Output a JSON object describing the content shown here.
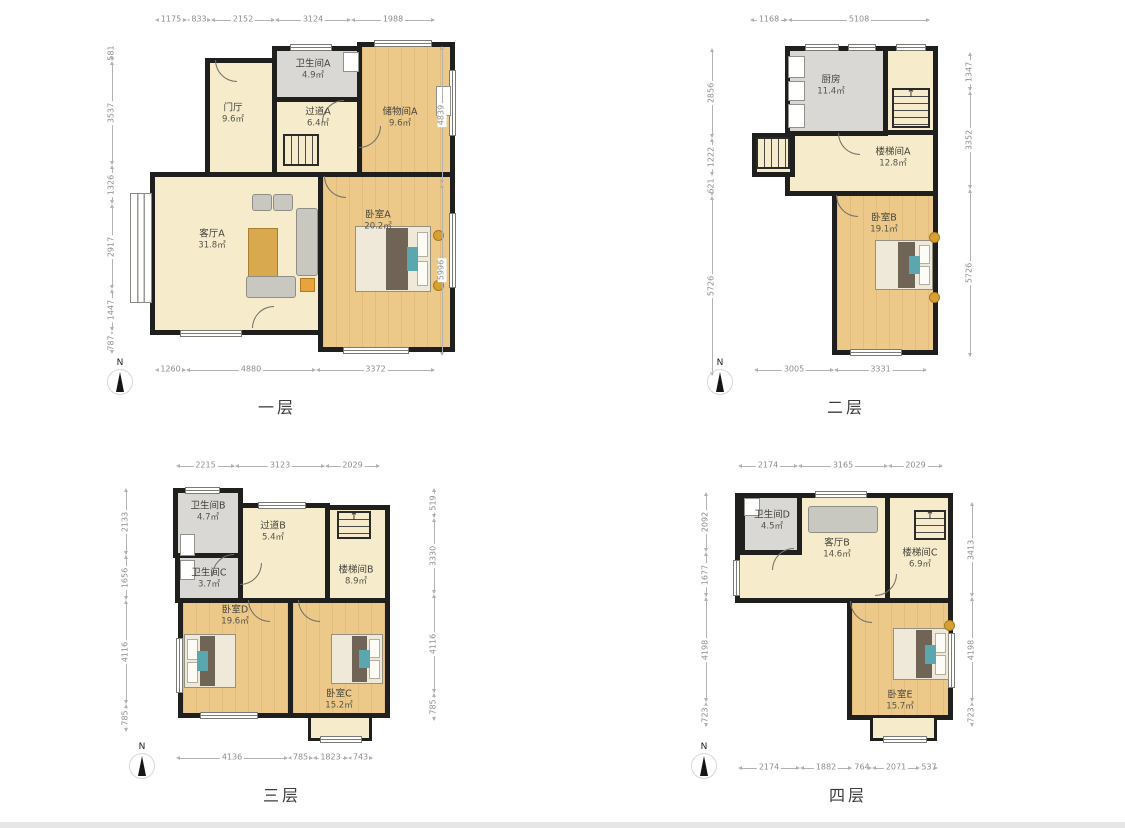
{
  "colors": {
    "wall": "#1f1f1e",
    "wood_floor": "#ecc988",
    "living_floor": "#f6eccb",
    "wet_room": "#d9d8d4",
    "dim_text": "#8e8d89"
  },
  "icons": {
    "up_arrow": "↑"
  },
  "floors": [
    {
      "label": "一层",
      "north": "N",
      "rooms": [
        {
          "name": "门厅",
          "area": "9.6㎡"
        },
        {
          "name": "卫生间A",
          "area": "4.9㎡"
        },
        {
          "name": "过道A",
          "area": "6.4㎡"
        },
        {
          "name": "储物间A",
          "area": "9.6㎡"
        },
        {
          "name": "客厅A",
          "area": "31.8㎡"
        },
        {
          "name": "卧室A",
          "area": "20.2㎡"
        }
      ],
      "dims": {
        "top": [
          "1175",
          "833",
          "2152",
          "3124",
          "1988"
        ],
        "left": [
          "581",
          "3537",
          "1326",
          "2917",
          "1447",
          "787"
        ],
        "right": [
          "4839",
          "5996"
        ],
        "bottom": [
          "1260",
          "4880",
          "3372"
        ]
      }
    },
    {
      "label": "二层",
      "north": "N",
      "rooms": [
        {
          "name": "厨房",
          "area": "11.4㎡"
        },
        {
          "name": "楼梯间A",
          "area": "12.8㎡"
        },
        {
          "name": "卧室B",
          "area": "19.1㎡"
        }
      ],
      "dims": {
        "top": [
          "1168",
          "5108"
        ],
        "left": [
          "2856",
          "1222",
          "621",
          "5726"
        ],
        "right": [
          "1347",
          "3352",
          "5726"
        ],
        "bottom": [
          "3005",
          "3331"
        ]
      }
    },
    {
      "label": "三层",
      "north": "N",
      "rooms": [
        {
          "name": "卫生间B",
          "area": "4.7㎡"
        },
        {
          "name": "过道B",
          "area": "5.4㎡"
        },
        {
          "name": "楼梯间B",
          "area": "8.9㎡"
        },
        {
          "name": "卫生间C",
          "area": "3.7㎡"
        },
        {
          "name": "卧室D",
          "area": "19.6㎡"
        },
        {
          "name": "卧室C",
          "area": "15.2㎡"
        }
      ],
      "dims": {
        "top": [
          "2215",
          "3123",
          "2029"
        ],
        "left": [
          "2133",
          "1656",
          "4116",
          "785"
        ],
        "right": [
          "519",
          "3330",
          "4116",
          "785"
        ],
        "bottom": [
          "4136",
          "785",
          "1823",
          "743"
        ]
      }
    },
    {
      "label": "四层",
      "north": "N",
      "rooms": [
        {
          "name": "卫生间D",
          "area": "4.5㎡"
        },
        {
          "name": "客厅B",
          "area": "14.6㎡"
        },
        {
          "name": "楼梯间C",
          "area": "6.9㎡"
        },
        {
          "name": "卧室E",
          "area": "15.7㎡"
        }
      ],
      "dims": {
        "top": [
          "2174",
          "3165",
          "2029"
        ],
        "left": [
          "2092",
          "1677",
          "4198",
          "723"
        ],
        "right": [
          "3413",
          "4198",
          "723"
        ],
        "bottom": [
          "2174",
          "1882",
          "764",
          "2071",
          "537"
        ]
      }
    }
  ]
}
